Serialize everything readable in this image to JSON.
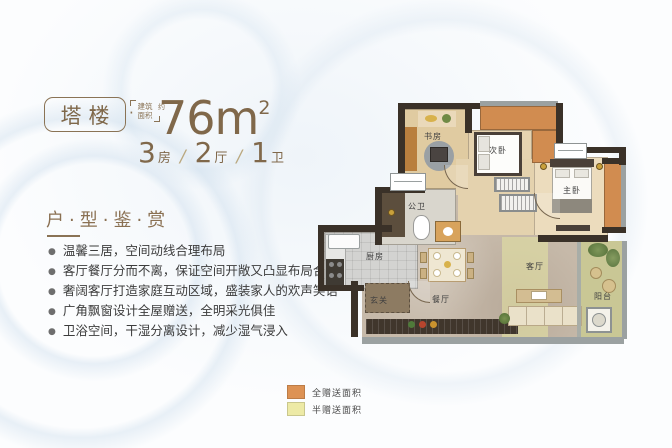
{
  "header": {
    "badge_label": "塔楼",
    "badge_dot": "·",
    "area_note_line1": "建筑",
    "area_note_line2": "面积",
    "area_note_suffix": "约",
    "area_value": "76m",
    "area_sup": "2",
    "units": [
      {
        "num": "3",
        "label": "房"
      },
      {
        "num": "2",
        "label": "厅"
      },
      {
        "num": "1",
        "label": "卫"
      }
    ],
    "separator": "/"
  },
  "section": {
    "title": "户·型·鉴·赏",
    "bullets": [
      "温馨三居，空间动线合理布局",
      "客厅餐厅分而不离，保证空间开敞又凸显布局合理",
      "奢阔客厅打造家庭互动区域，盛装家人的欢声笑语",
      "广角飘窗设计全屋赠送，全明采光俱佳",
      "卫浴空间，干湿分离设计，减少湿气浸入"
    ]
  },
  "floorplan": {
    "rooms": [
      {
        "id": "study",
        "label": "书房"
      },
      {
        "id": "bedroom2",
        "label": "次卧"
      },
      {
        "id": "master-bedroom",
        "label": "主卧"
      },
      {
        "id": "bathroom",
        "label": "公卫"
      },
      {
        "id": "kitchen",
        "label": "厨房"
      },
      {
        "id": "foyer",
        "label": "玄关"
      },
      {
        "id": "dining",
        "label": "餐厅"
      },
      {
        "id": "living",
        "label": "客厅"
      },
      {
        "id": "balcony",
        "label": "阳台"
      }
    ],
    "legend": [
      {
        "label": "全赠送面积",
        "color": "#dd9254"
      },
      {
        "label": "半赠送面积",
        "color": "#edeaa6"
      }
    ]
  },
  "colors": {
    "accent_bronze": "#84694a",
    "wall_dark": "#3a3128",
    "gift_full": "#d18c50",
    "gift_half": "#e6e6a2"
  }
}
